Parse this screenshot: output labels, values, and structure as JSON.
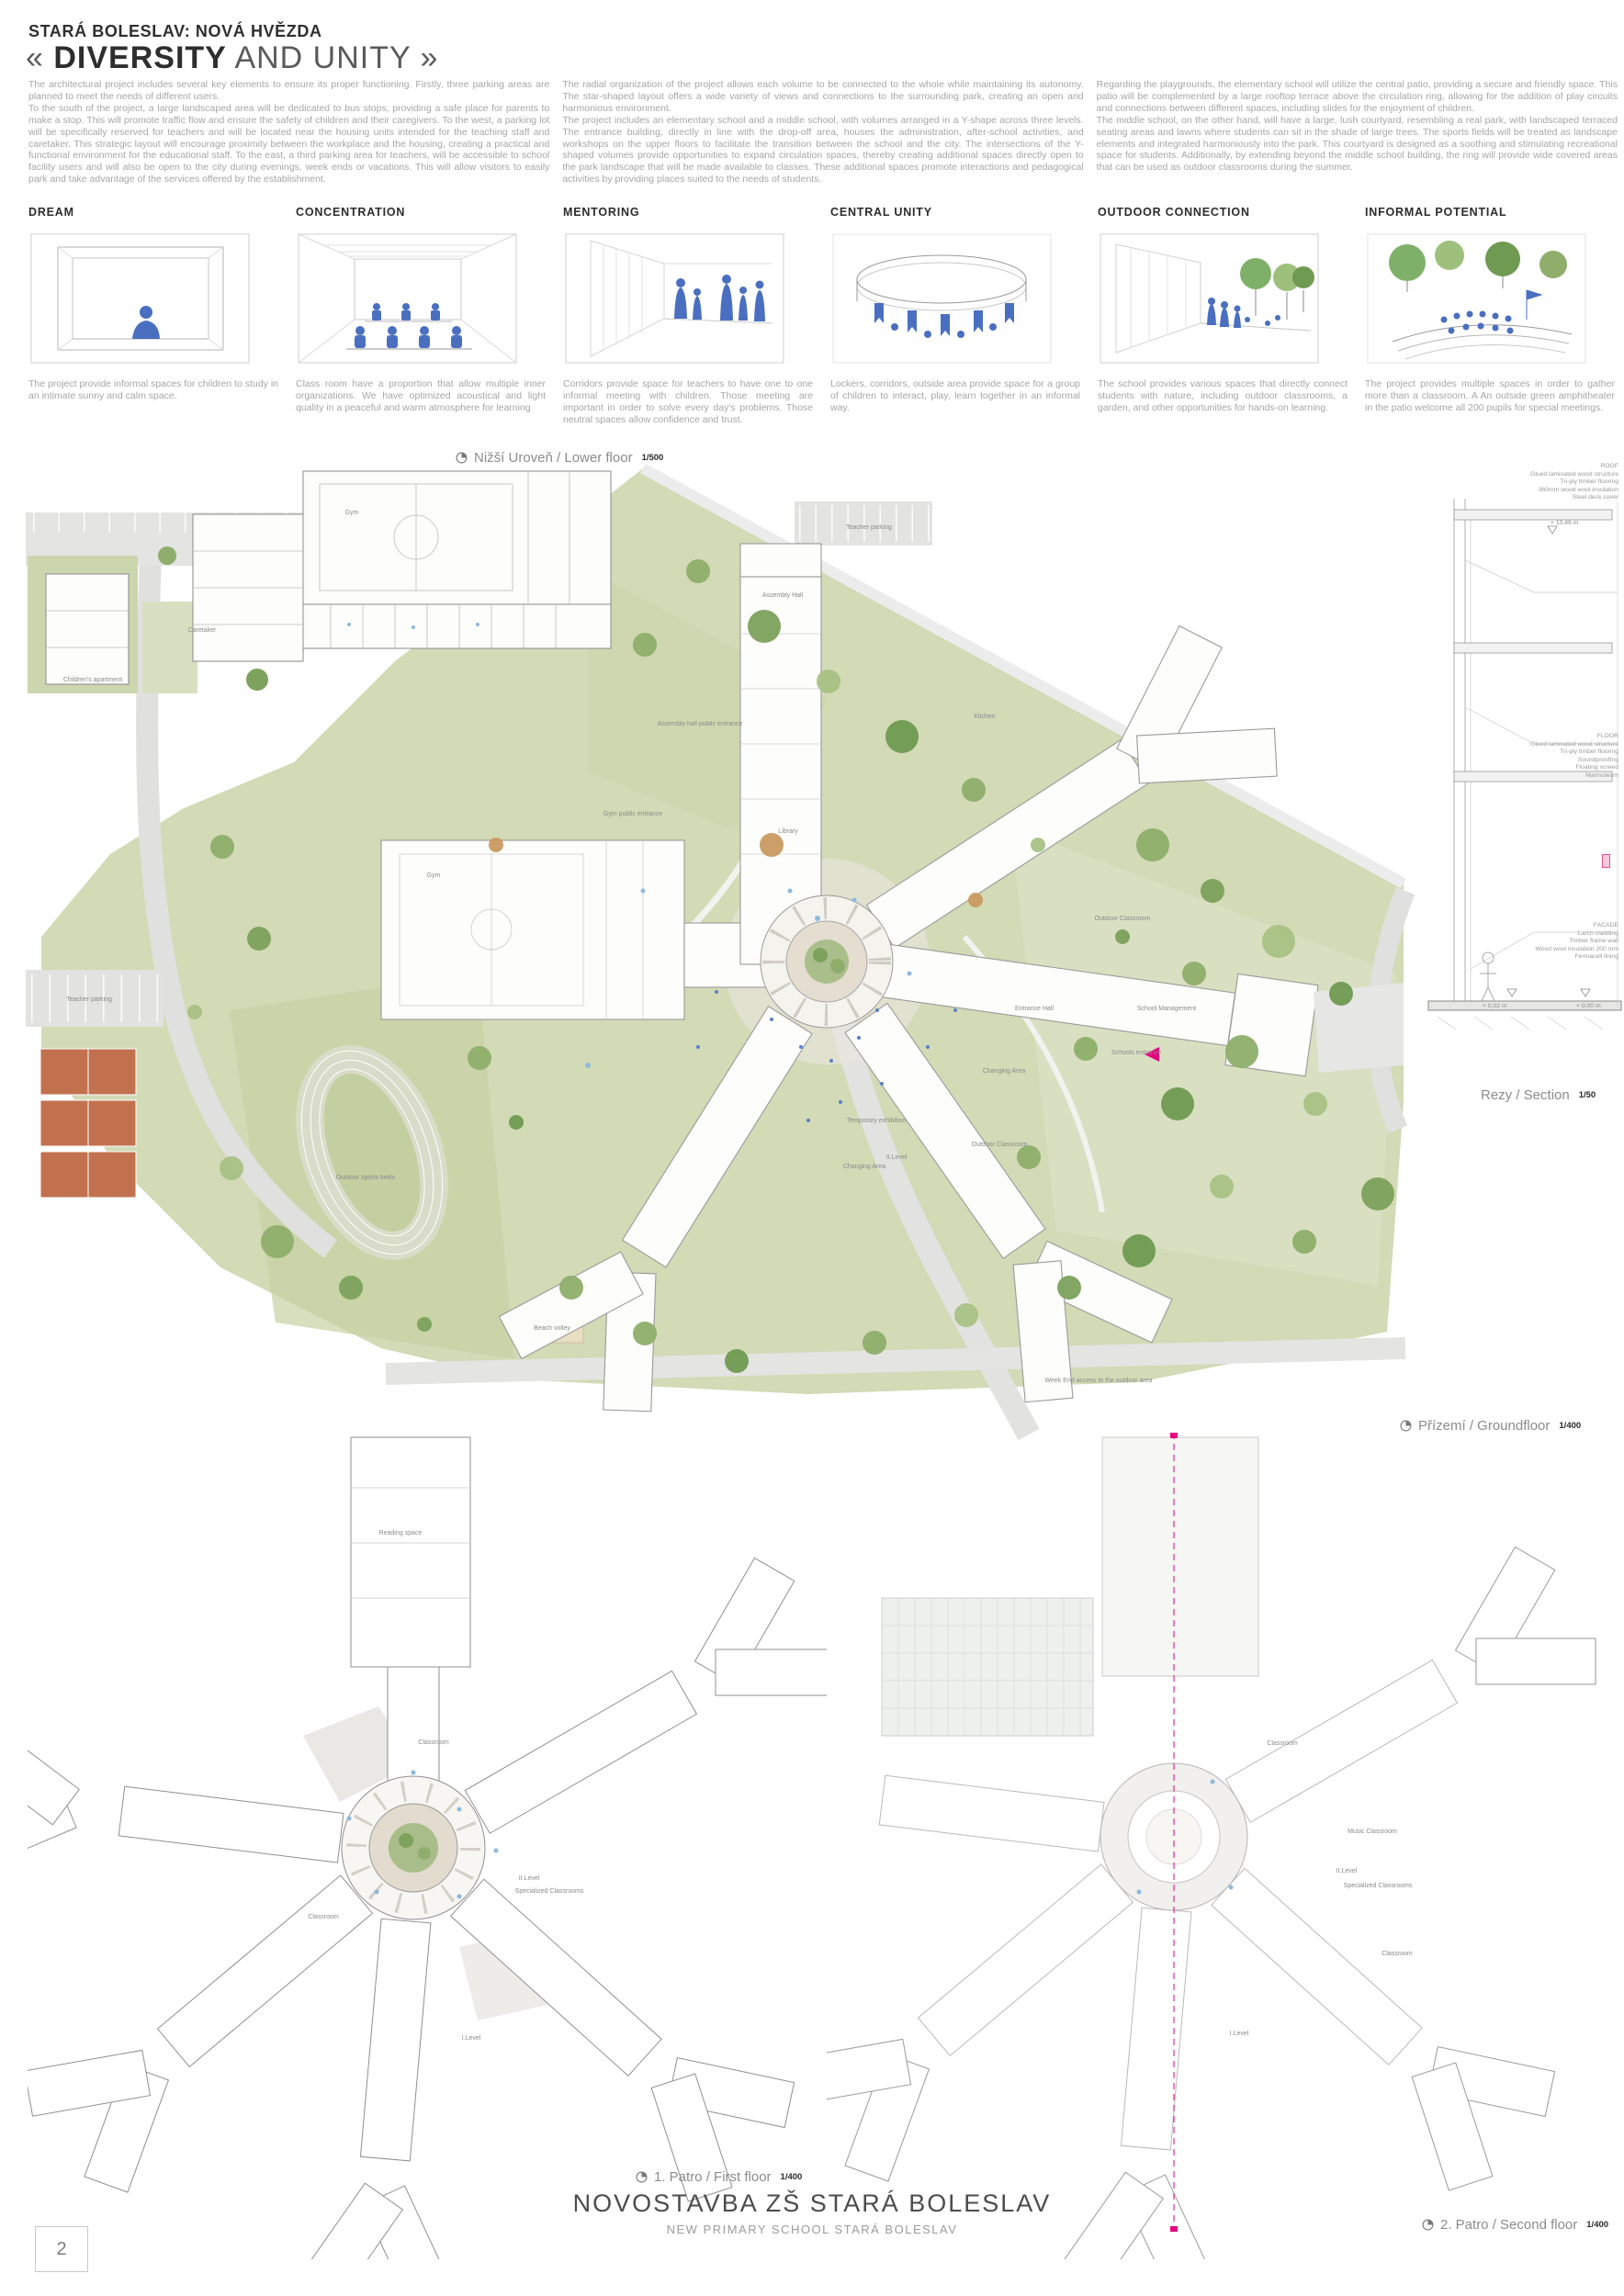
{
  "header": {
    "project": "STARÁ BOLESLAV: NOVÁ HVĚZDA",
    "title_prefix": "«",
    "title_bold": "DIVERSITY",
    "title_suffix": "AND UNITY »"
  },
  "intro": {
    "col1": {
      "p1": "The architectural project includes several key elements to ensure its proper functioning. Firstly, three parking areas are planned to meet the needs of different users.",
      "p2": "To the south of the project, a large landscaped area will be dedicated to bus stops, providing a safe place for parents to make a stop. This will promote traffic flow and ensure the safety of children and their caregivers. To the west, a parking lot will be specifically reserved for teachers and will be located near the housing units intended for the teaching staff and caretaker. This strategic layout will encourage proximity between the workplace and the housing, creating a practical and functional environment for the educational staff. To the east, a third parking area for teachers, will be accessible to school facility users and will also be open to the city during evenings, week ends or vacations. This will allow visitors to easily park and take advantage of the services offered by the establishment."
    },
    "col2": {
      "p1": "The radial organization of the project allows each volume to be connected to the whole while maintaining its autonomy. The star-shaped layout offers a wide variety of views and connections to the surrounding park, creating an open and harmonious environment.",
      "p2": "The project includes an elementary school and a middle school, with volumes arranged in a Y-shape across three levels. The entrance building, directly in line with the drop-off area, houses the administration, after-school activities, and workshops on the upper floors to facilitate the transition between the school and the city. The intersections of the Y-shaped volumes provide opportunities to expand circulation spaces, thereby creating additional spaces directly open to the park landscape that will be made available to classes. These additional spaces promote interactions and pedagogical activities by providing places suited to the needs of students."
    },
    "col3": {
      "p1": "Regarding the playgrounds, the elementary school will utilize the central patio, providing a secure and friendly space. This patio will be complemented by a large rooftop terrace above the circulation ring, allowing for the addition of play circuits and connections between different spaces, including slides for the enjoyment of children.",
      "p2": "The middle school, on the other hand, will have a large, lush courtyard, resembling a real park, with landscaped terraced seating areas and lawns where students can sit in the shade of large trees. The sports fields will be treated as landscape elements and integrated harmoniously into the park. This courtyard is designed as a soothing and stimulating recreational space for students. Additionally, by extending beyond the middle school building, the ring will provide wide covered areas that can be used as outdoor classrooms during the summer."
    }
  },
  "concepts": [
    {
      "label": "DREAM",
      "caption": "The project provide informal spaces for children to study in an intimate sunny and calm space."
    },
    {
      "label": "CONCENTRATION",
      "caption": "Class room have a proportion that allow multiple inner organizations. We have optimized acoustical and light quality in a peaceful and warm atmosphere for learning"
    },
    {
      "label": "MENTORING",
      "caption": "Corridors provide space for teachers to have one to one informal meeting with children. Those meeting are important in order to solve every day's problems. Those neutral spaces allow confidence and trust."
    },
    {
      "label": "CENTRAL UNITY",
      "caption": "Lockers, corridors, outside area provide space for a group of children to interact, play, learn together in an informal way."
    },
    {
      "label": "OUTDOOR CONNECTION",
      "caption": "The school provides various spaces that directly connect students with nature, including outdoor classrooms, a garden, and other opportunities for hands-on learning."
    },
    {
      "label": "INFORMAL POTENTIAL",
      "caption": "The project provides multiple spaces in order to gather more than a classroom. A An outside green amphitheater in the patio welcome all 200 pupils for special meetings."
    }
  ],
  "plans": {
    "lower": {
      "label": "Nižší Uroveň / Lower floor",
      "scale": "1/500"
    },
    "ground": {
      "label": "Přízemí / Groundfloor",
      "scale": "1/400"
    },
    "section": {
      "label": "Rezy / Section",
      "scale": "1/50"
    },
    "first": {
      "label": "1. Patro / First floor",
      "scale": "1/400"
    },
    "second": {
      "label": "2. Patro / Second floor",
      "scale": "1/400"
    }
  },
  "section_notes": {
    "roof": [
      "ROOF",
      "Glued laminated wood structure",
      "Tri-ply timber flooring",
      "360mm wood wool insulation",
      "Steel deck cover"
    ],
    "floor": [
      "FLOOR",
      "Glued laminated wood structure",
      "Tri-ply timber flooring",
      "Soundproofing",
      "Floating screed",
      "Marmoleum"
    ],
    "facade": [
      "FACADE",
      "Larch cladding",
      "Timber frame wall",
      "Wood wool insulation 200 mm",
      "Fermacell lining"
    ],
    "levels": [
      "+ 10,46 m",
      "+ 0,02 m",
      "+ 0,00 m"
    ]
  },
  "annotations": [
    "Assembly Hall",
    "Library",
    "Gym",
    "Entrance Hall",
    "School Management",
    "Kitchen",
    "Teacher parking",
    "Teacher parking",
    "Outdoor Classroom",
    "Outdoor Classroom",
    "Changing Area",
    "Changing Area",
    "II.Level",
    "Temporary exhibition",
    "Schools entrance",
    "Outdoor sports fields",
    "Beach volley",
    "Week End access to the outdoor area",
    "Gym public entrance",
    "Assembly hall public entrance",
    "Caretaker",
    "Children's apartment",
    "Gym",
    "Reading space",
    "II.Level",
    "Specialized Classrooms",
    "I.Level",
    "Classroom",
    "Classroom",
    "Music Classroom",
    "II.Level",
    "Specialized Classrooms",
    "I.Level",
    "Classroom",
    "Classroom"
  ],
  "footer": {
    "title": "NOVOSTAVBA ZŠ STARÁ BOLESLAV",
    "subtitle": "NEW PRIMARY SCHOOL STARÁ BOLESLAV",
    "page": "2"
  },
  "colors": {
    "figure_blue": "#4a6fc0",
    "tree_green": "#8fae6b",
    "park_green": "#d2dab6",
    "court_clay": "#c2714f",
    "accent_magenta": "#e6007e"
  }
}
